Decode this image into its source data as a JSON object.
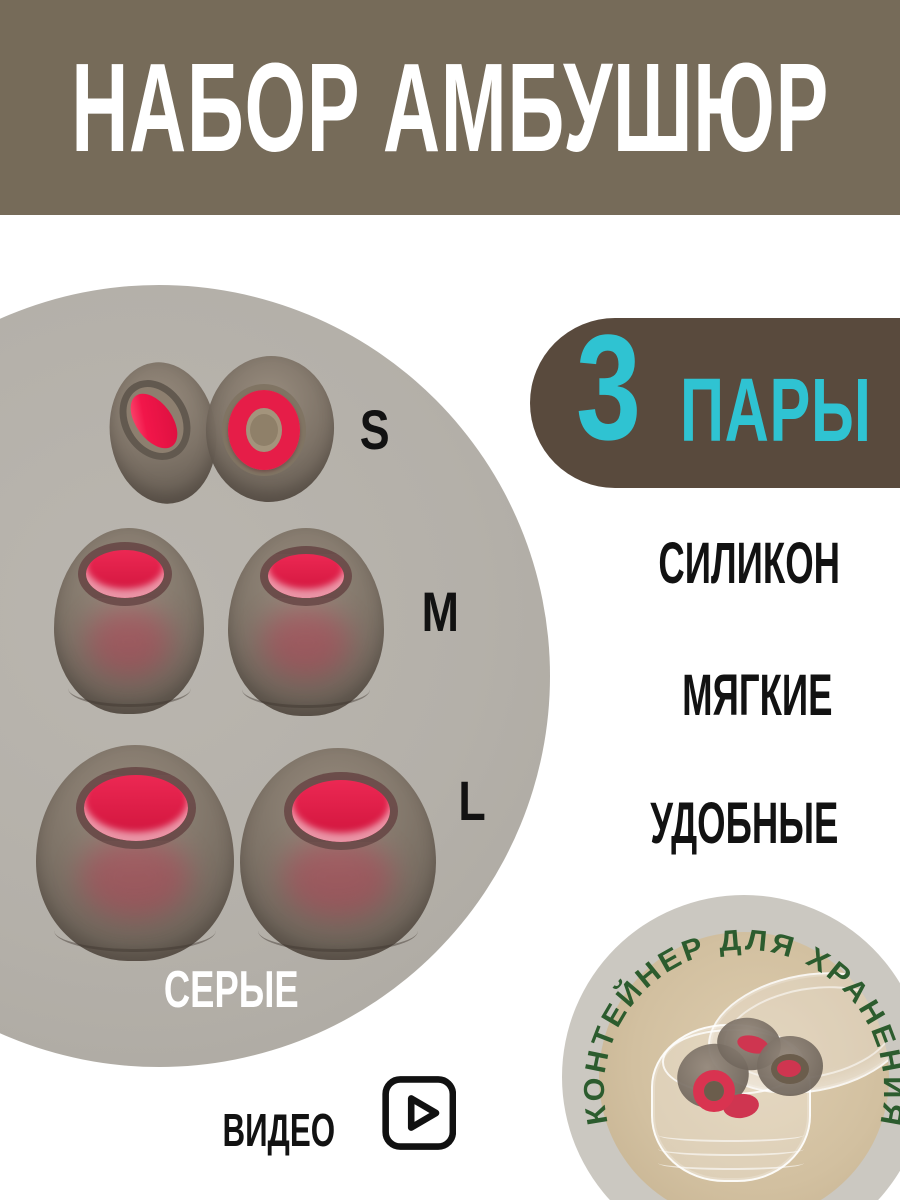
{
  "banner": {
    "title": "НАБОР АМБУШЮР",
    "bg_color": "#766b59",
    "text_color": "#ffffff"
  },
  "product": {
    "sizes": [
      {
        "label": "S"
      },
      {
        "label": "M"
      },
      {
        "label": "L"
      }
    ],
    "color_label": "СЕРЫЕ",
    "tip_body_color": "#7c7165",
    "tip_red_color": "#ec2853",
    "photo_circle_color": "#b4b0a9"
  },
  "badge": {
    "count": "3",
    "unit": "ПАРЫ",
    "bg_color": "#594a3d",
    "text_color": "#2fc3d2"
  },
  "features": [
    {
      "label": "СИЛИКОН"
    },
    {
      "label": "МЯГКИЕ"
    },
    {
      "label": "УДОБНЫЕ"
    }
  ],
  "storage": {
    "label": "КОНТЕЙНЕР ДЛЯ ХРАНЕНИЯ",
    "label_color": "#2c5c2e",
    "ring_color": "#cbc8c1",
    "photo_bg_color": "#d2c0a0"
  },
  "video": {
    "label": "ВИДЕО",
    "icon": "play-icon"
  }
}
